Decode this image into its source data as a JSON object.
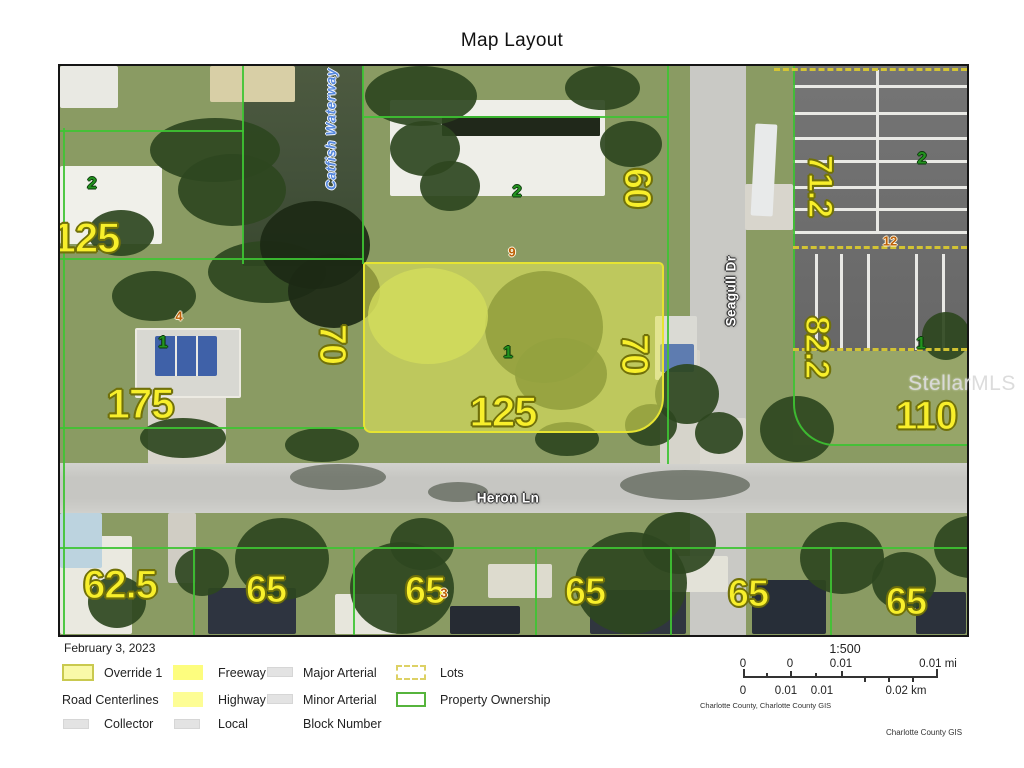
{
  "title": "Map Layout",
  "date": "February 3, 2023",
  "map": {
    "watermark": "StellarMLS",
    "waterway": "Catfish Waterway",
    "street_horizontal": "Heron Ln",
    "street_vertical": "Seagull Dr",
    "dimensions": {
      "left125": "125",
      "center125": "125",
      "d175": "175",
      "left70": "70",
      "right70": "70",
      "d60": "60",
      "d71_2": "71.2",
      "d82_2": "82.2",
      "d110": "110",
      "d62_5": "62.5",
      "d65": [
        "65",
        "65",
        "65",
        "65",
        "65"
      ]
    },
    "parcel_numbers": {
      "p2a": "2",
      "p2b": "2",
      "p2c": "2",
      "p1a": "1",
      "p1b": "1",
      "p1c": "1"
    },
    "block_numbers": {
      "b9": "9",
      "b4": "4",
      "b12": "12",
      "b3": "3"
    }
  },
  "legend": {
    "override": "Override 1",
    "road_centerlines": "Road Centerlines",
    "collector": "Collector",
    "freeway": "Freeway",
    "highway": "Highway",
    "local": "Local",
    "major_arterial": "Major Arterial",
    "minor_arterial": "Minor Arterial",
    "block_number": "Block Number",
    "lots": "Lots",
    "property_ownership": "Property Ownership"
  },
  "scalebar": {
    "ratio": "1:500",
    "top_labels": [
      "0",
      "0",
      "0.01",
      "0.01 mi"
    ],
    "bottom_labels": [
      "0",
      "0.01",
      "0.01",
      "0.02 km"
    ],
    "attribution": "Charlotte County, Charlotte County GIS"
  },
  "footer": {
    "credit": "Charlotte County GIS"
  },
  "colors": {
    "dimension_label": "#f8ef2b",
    "dimension_outline": "#71710a",
    "parcel_number_green": "#23931f",
    "block_number_orange": "#bd5f07",
    "property_line_green": "#3ec433",
    "lot_dashed_yellow": "#d8c832",
    "highlight_fill": "#e9ec5a",
    "highlight_border": "#e6e432",
    "road_gray": "#c9c9c5",
    "parking_gray": "#6f6f6f",
    "water_green": "#43513a",
    "street_label_white": "#ffffff",
    "waterway_blue": "#5588dd"
  }
}
